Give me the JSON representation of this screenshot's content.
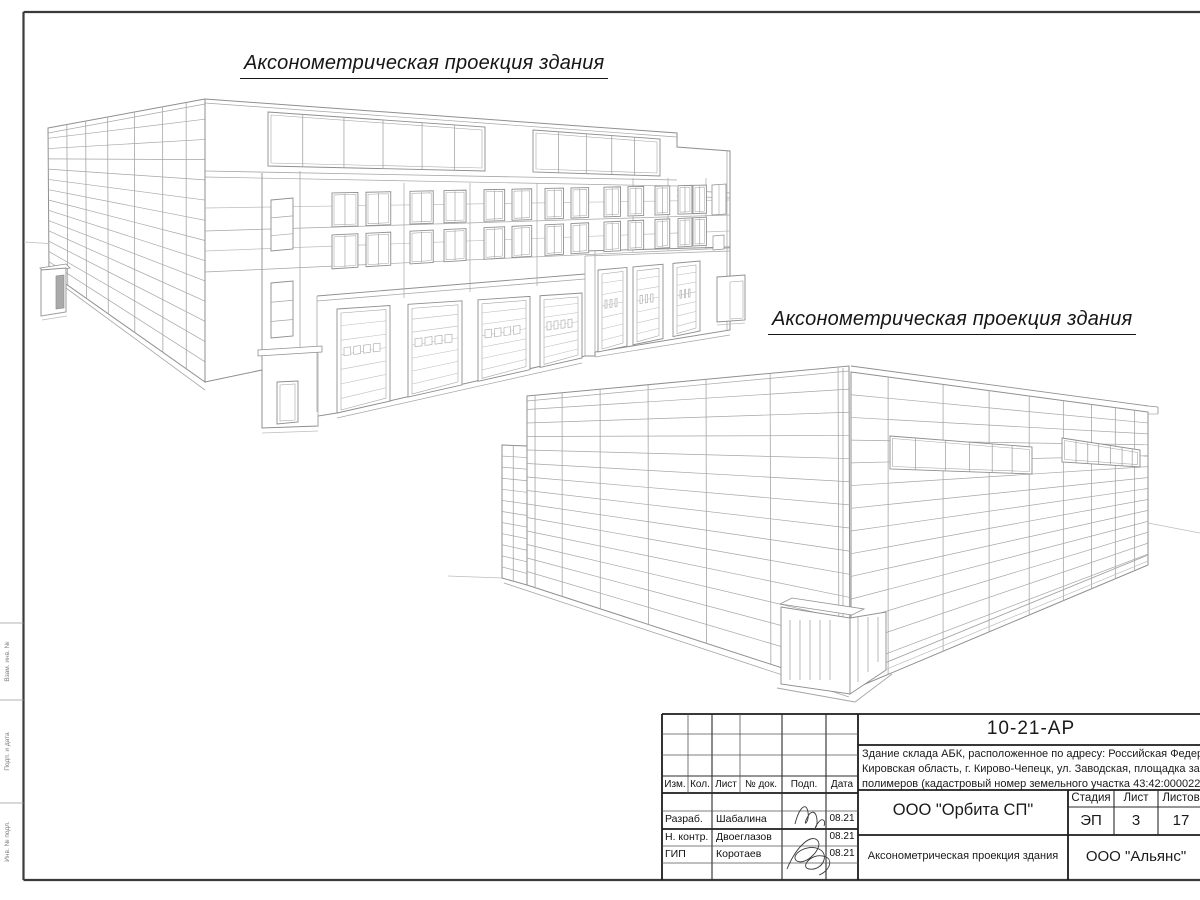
{
  "drawing_titles": {
    "view_1": "Аксонометрическая проекция здания",
    "view_2": "Аксонометрическая проекция здания"
  },
  "title_block": {
    "doc_number": "10-21-АР",
    "description_lines": [
      "Здание склада АБК, расположенное по адресу: Российская Федерация,",
      "Кировская область, г. Кирово-Чепецк, ул. Заводская, площадка завода",
      "полимеров (кадастровый номер земельного участка 43:42:000022:"
    ],
    "columns": {
      "izm": "Изм.",
      "kol": "Кол.",
      "list": "Лист",
      "doc_no": "№ док.",
      "podp": "Подп.",
      "data": "Дата"
    },
    "rows": [
      {
        "role": "Разраб.",
        "name": "Шабалина",
        "date": "08.21"
      },
      {
        "role": "Н. контр.",
        "name": "Двоеглазов",
        "date": "08.21"
      },
      {
        "role": "ГИП",
        "name": "Коротаев",
        "date": "08.21"
      }
    ],
    "org": "ООО \"Орбита СП\"",
    "stage_label": "Стадия",
    "sheet_label": "Лист",
    "sheets_label": "Листов",
    "stage": "ЭП",
    "sheet_no": "3",
    "sheets_total": "17",
    "caption": "Аксонометрическая проекция здания",
    "contractor": "ООО \"Альянс\""
  },
  "side_stamp": {
    "labels": [
      "Взам. инв. №",
      "Подп. и дата",
      "Инв. № подл."
    ]
  }
}
